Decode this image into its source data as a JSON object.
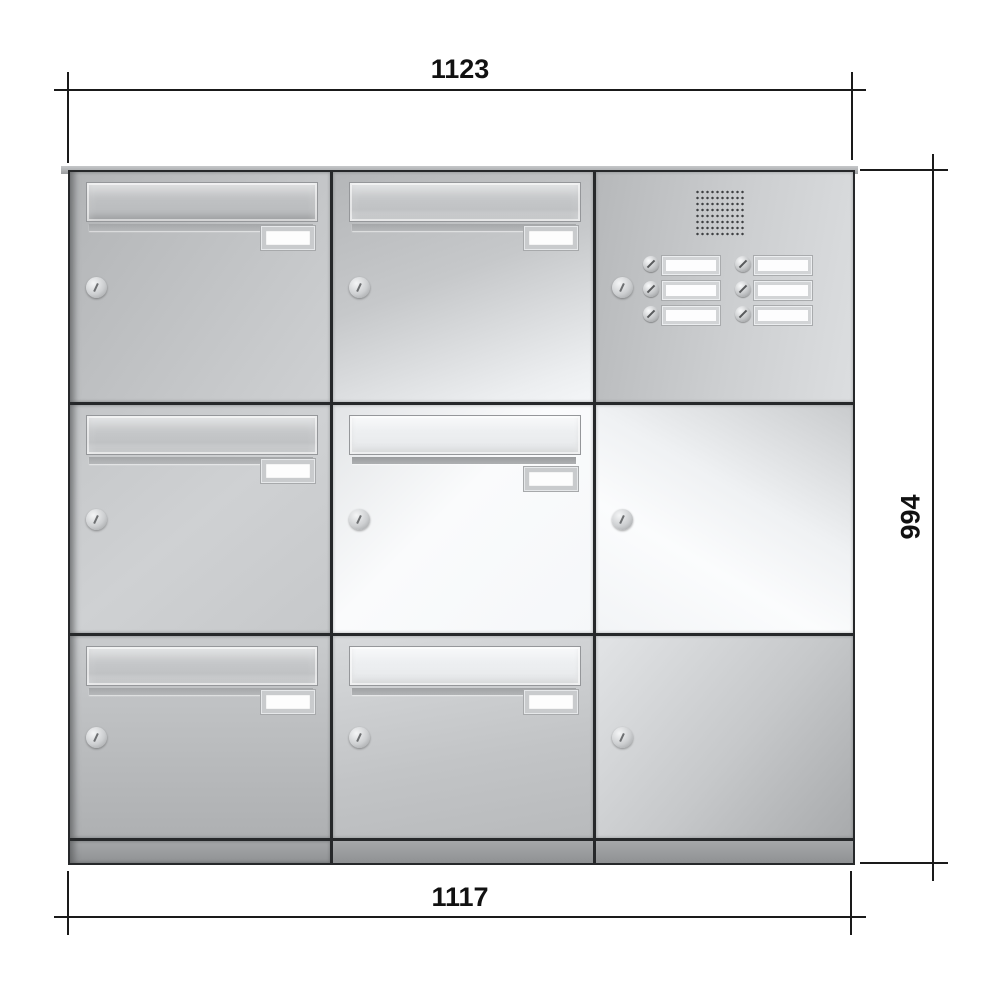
{
  "dimensions": {
    "top_width": "1123",
    "right_height": "994",
    "bottom_width": "1117"
  },
  "unit": {
    "rows": 3,
    "cols": 3,
    "material": "stainless-steel",
    "cells": [
      {
        "position": "row1-col1",
        "type": "mailbox",
        "parts": [
          "letter-flap",
          "name-plate",
          "lock"
        ]
      },
      {
        "position": "row1-col2",
        "type": "mailbox",
        "parts": [
          "letter-flap",
          "name-plate",
          "lock"
        ]
      },
      {
        "position": "row1-col3",
        "type": "intercom",
        "parts": [
          "speaker-grille",
          "lock"
        ],
        "bell_buttons": 6,
        "bell_name_plates": 6
      },
      {
        "position": "row2-col1",
        "type": "mailbox",
        "parts": [
          "letter-flap",
          "name-plate",
          "lock"
        ]
      },
      {
        "position": "row2-col2",
        "type": "mailbox",
        "parts": [
          "letter-flap",
          "name-plate",
          "lock"
        ]
      },
      {
        "position": "row2-col3",
        "type": "blank-panel",
        "parts": [
          "lock"
        ]
      },
      {
        "position": "row3-col1",
        "type": "mailbox",
        "parts": [
          "letter-flap",
          "name-plate",
          "lock"
        ]
      },
      {
        "position": "row3-col2",
        "type": "mailbox",
        "parts": [
          "letter-flap",
          "name-plate",
          "lock"
        ]
      },
      {
        "position": "row3-col3",
        "type": "blank-panel",
        "parts": [
          "lock"
        ]
      }
    ]
  },
  "colors": {
    "steel_light": "#f4f6f8",
    "steel_mid": "#c2c4c6",
    "steel_dark": "#a8aaac",
    "divider": "#26282a",
    "dimension_line": "#1a1a1a",
    "plate_white": "#fdfdfd"
  }
}
